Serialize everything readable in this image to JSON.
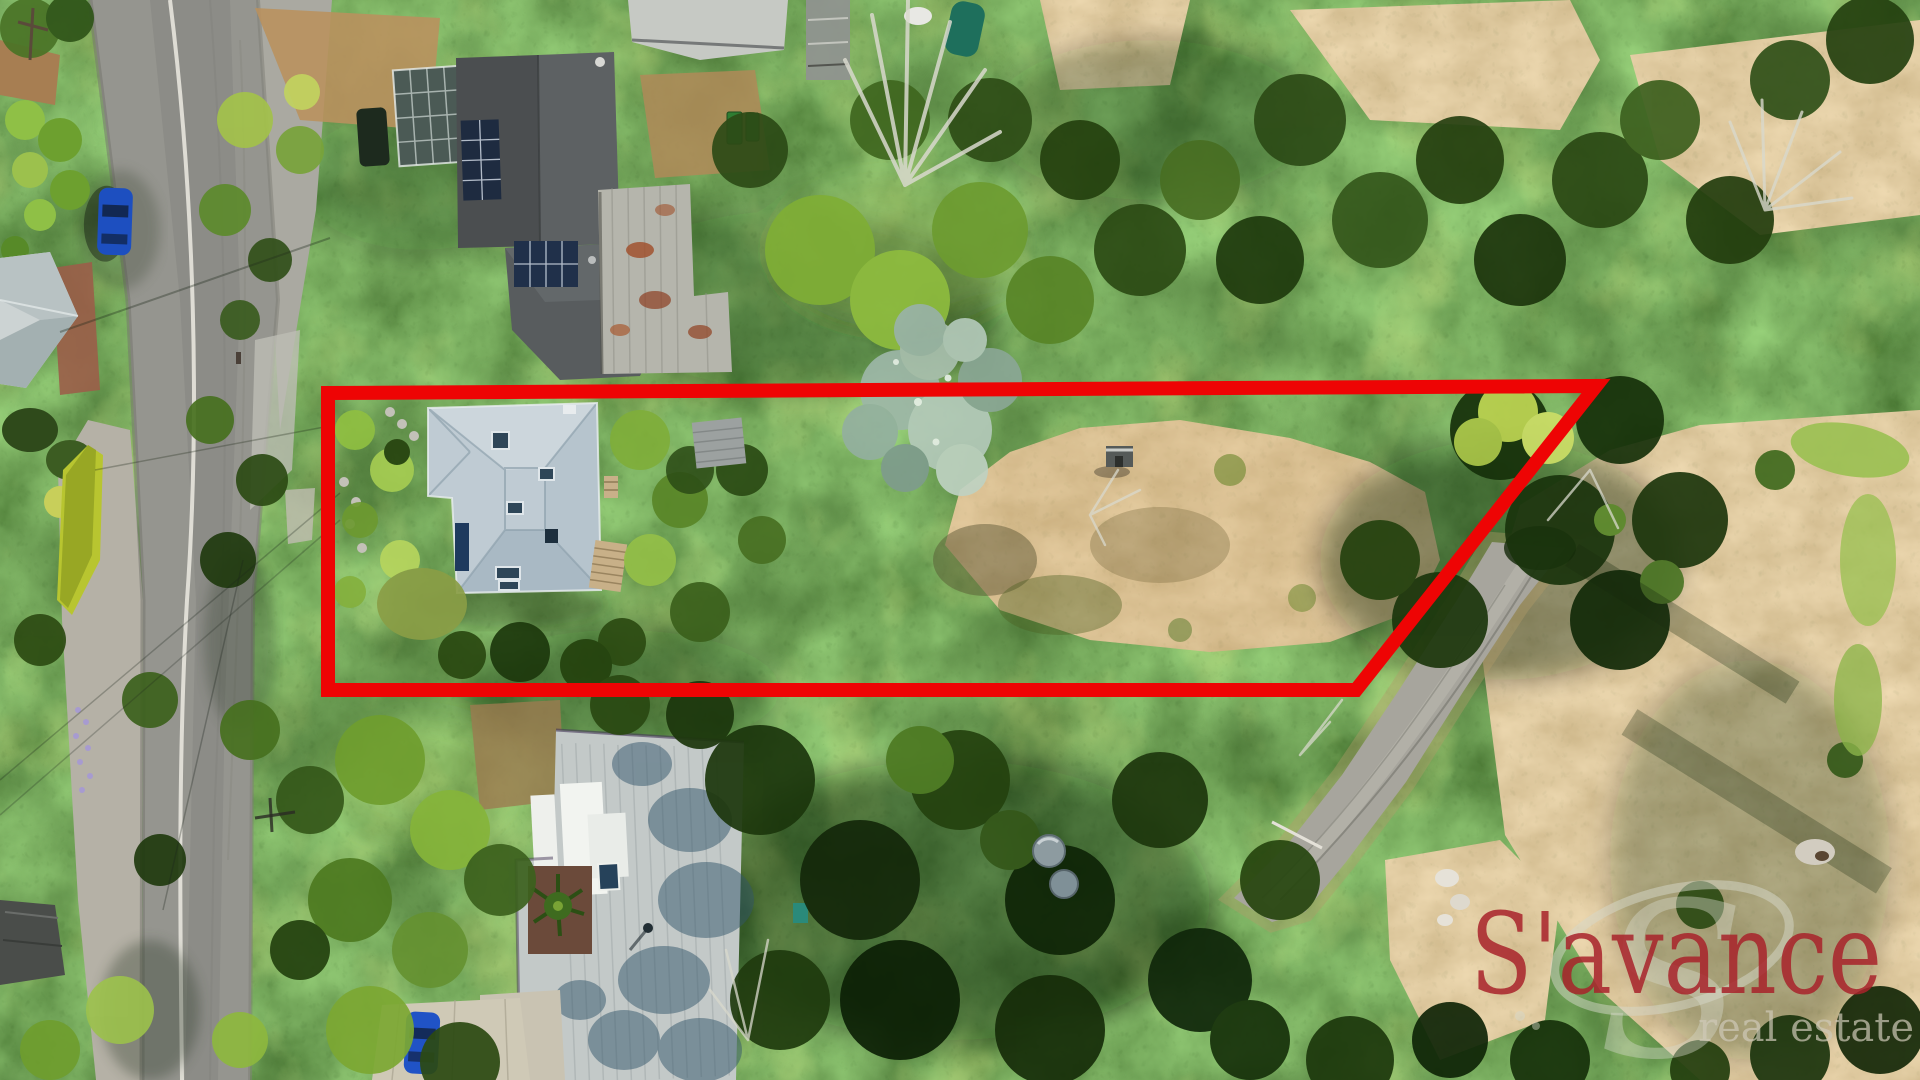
{
  "watermark": {
    "monogram": "S",
    "brand": "S'avance",
    "tagline": "real estate"
  },
  "colors": {
    "boundary": "#ee0404",
    "brand_red": "#a8232b",
    "watermark_gray": "#d6d8ca",
    "tagline_gray": "#cfc9b8"
  }
}
